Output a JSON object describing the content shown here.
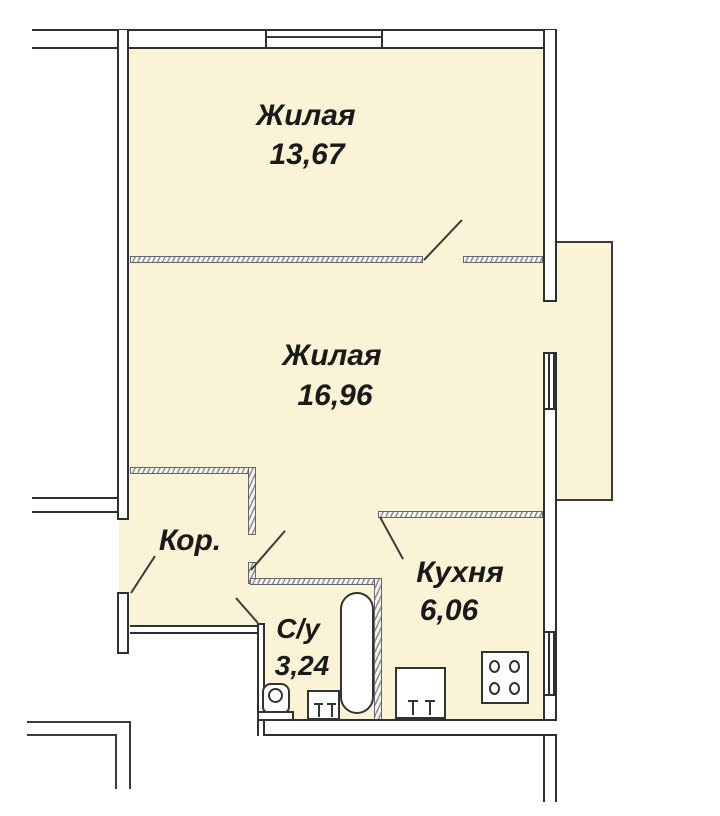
{
  "plan_title": "Apartment floor plan",
  "colors": {
    "room_fill": "#FAF3D5",
    "wall": "#2F2F2F",
    "hatch": "#8F8F8F",
    "text": "#1A1A1A",
    "background": "#FFFFFF"
  },
  "rooms": [
    {
      "name": "living-room-1",
      "label": "Жилая",
      "area": "13,67"
    },
    {
      "name": "living-room-2",
      "label": "Жилая",
      "area": "16,96"
    },
    {
      "name": "corridor",
      "label": "Кор.",
      "area": ""
    },
    {
      "name": "bathroom",
      "label": "С/у",
      "area": "3,24"
    },
    {
      "name": "kitchen",
      "label": "Кухня",
      "area": "6,06"
    }
  ],
  "fixtures": [
    "bathtub",
    "toilet",
    "washbasin",
    "kitchen-sink",
    "stove"
  ]
}
